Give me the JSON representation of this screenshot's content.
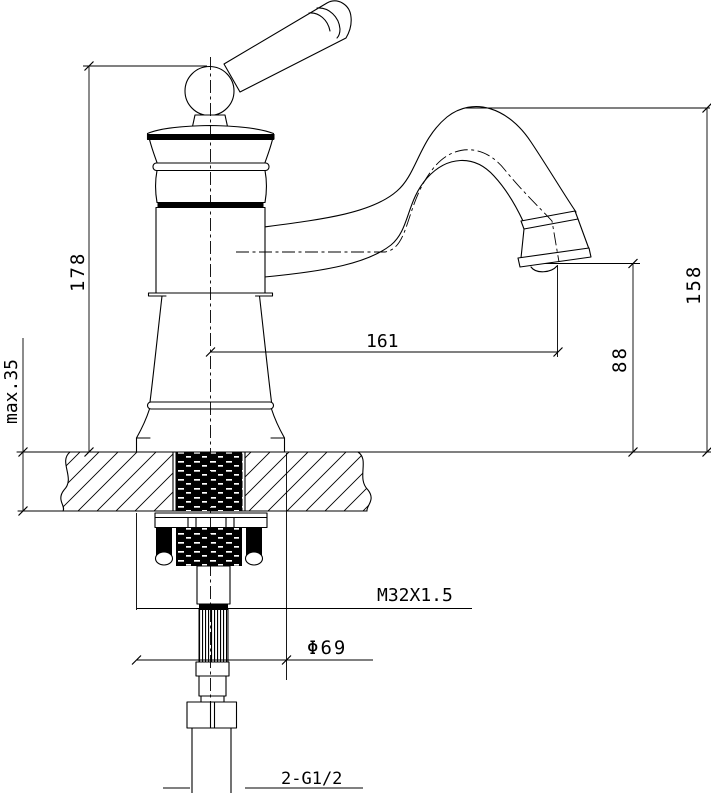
{
  "drawing": {
    "labels": {
      "overall_height": "178",
      "max_counter_thickness": "max.35",
      "spout_reach": "161",
      "outlet_height": "88",
      "spout_top_height": "158",
      "shank_thread": "M32X1.5",
      "base_diameter": "Φ69",
      "inlet_thread": "2-G1/2"
    },
    "colors": {
      "line": "#000000",
      "background": "#ffffff"
    }
  }
}
